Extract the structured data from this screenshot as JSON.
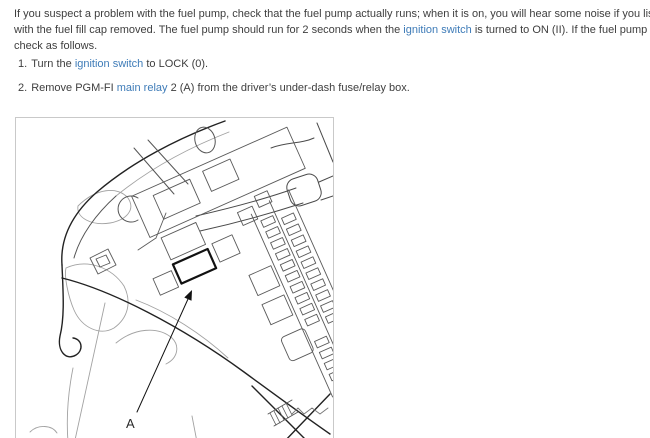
{
  "intro": {
    "line1": "If you suspect a problem with the fuel pump, check that the fuel pump actually runs; when it is on, you will hear some noise if you listen to the fuel fill port",
    "line2_pre": "with the fuel fill cap removed. The fuel pump should run for 2 seconds when the ",
    "line2_link": "ignition switch",
    "line2_post": " is turned to ON (II). If the fuel pump does not make noise,",
    "line3": "check as follows."
  },
  "steps": [
    {
      "num": "1.",
      "pre": "Turn the ",
      "link": "ignition switch",
      "post": " to LOCK (0)."
    },
    {
      "num": "2.",
      "pre": "Remove PGM-FI ",
      "link": "main relay",
      "post": " 2 (A) from the driver’s under-dash fuse/relay box."
    }
  ],
  "figure": {
    "description": "Under-dash fuse/relay box line drawing with PGM-FI main relay 2 highlighted",
    "callout_label": "A"
  },
  "colors": {
    "body_text": "#3e3e3e",
    "link": "#3f7cb8",
    "figure_border": "#c9c9c9"
  }
}
